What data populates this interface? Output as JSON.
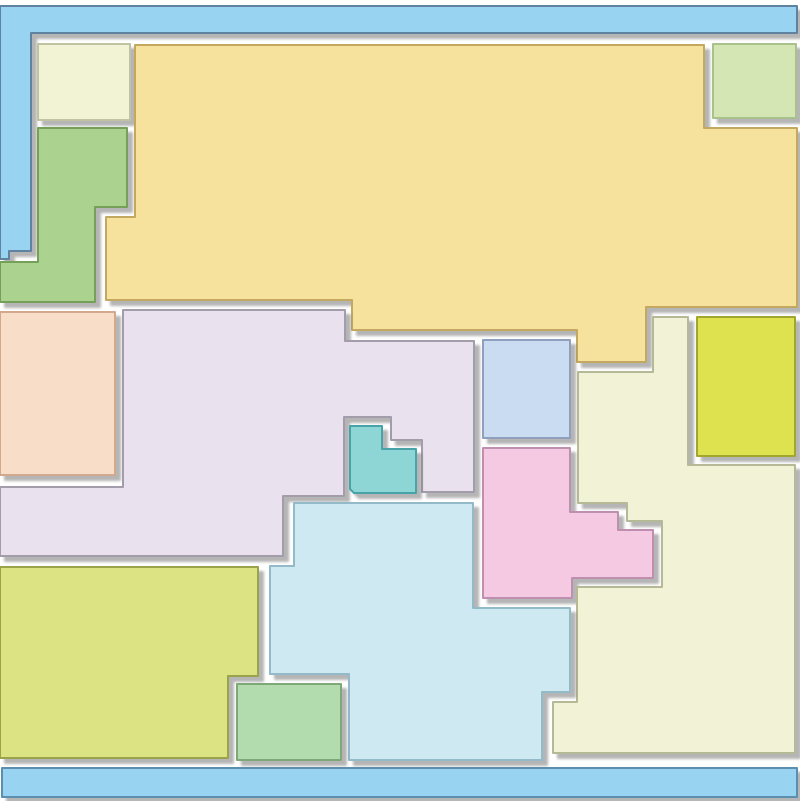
{
  "canvas": {
    "width": 800,
    "height": 801,
    "background": "#ffffff",
    "shadow": {
      "dx": 5,
      "dy": 5,
      "blur": 1.2,
      "color": "#777777",
      "opacity": 0.55
    }
  },
  "palette": {
    "frame_blue": "#98d3f2",
    "frame_blue_stroke": "#5e82a0",
    "bar_blue_stroke": "#5b8fae",
    "yellow": "#f6e29c",
    "ivory": "#f1f2d6",
    "lavender": "#e9e2ee",
    "cyan": "#cfe9f2",
    "lime": "#dce383",
    "chartreuse": "#dfe24f",
    "pink": "#f4c9e1",
    "peach": "#f8ddc9",
    "periwinkle": "#c9dcf2",
    "teal": "#8ed6d6",
    "green": "#abd28e",
    "mint": "#b3dcae",
    "pale_cream": "#f2f2d5",
    "pale_green": "#d4e6b4"
  },
  "shapes": [
    {
      "name": "region-frame-top-left-blue",
      "fill": "#98d3f2",
      "stroke": "#5e82a0",
      "points": [
        [
          0,
          6
        ],
        [
          797,
          6
        ],
        [
          797,
          33
        ],
        [
          31,
          33
        ],
        [
          31,
          251
        ],
        [
          9,
          251
        ],
        [
          9,
          259
        ],
        [
          0,
          259
        ]
      ]
    },
    {
      "name": "region-bottom-bar-blue",
      "fill": "#98d3f2",
      "stroke": "#5b8fae",
      "points": [
        [
          2,
          768
        ],
        [
          797,
          768
        ],
        [
          797,
          797
        ],
        [
          2,
          797
        ]
      ]
    },
    {
      "name": "region-pale-cream-rect-top-left",
      "fill": "#f2f2d5",
      "stroke": "#bfc3a0",
      "points": [
        [
          38,
          44
        ],
        [
          130,
          44
        ],
        [
          130,
          120
        ],
        [
          38,
          120
        ]
      ]
    },
    {
      "name": "region-green-left",
      "fill": "#abd28e",
      "stroke": "#74a058",
      "points": [
        [
          38,
          128
        ],
        [
          127,
          128
        ],
        [
          127,
          207
        ],
        [
          95,
          207
        ],
        [
          95,
          302
        ],
        [
          0,
          302
        ],
        [
          0,
          262
        ],
        [
          38,
          262
        ]
      ]
    },
    {
      "name": "region-yellow-large-top",
      "fill": "#f6e29c",
      "stroke": "#c2a95f",
      "points": [
        [
          135,
          45
        ],
        [
          704,
          45
        ],
        [
          704,
          128
        ],
        [
          797,
          128
        ],
        [
          797,
          307
        ],
        [
          646,
          307
        ],
        [
          646,
          362
        ],
        [
          577,
          362
        ],
        [
          577,
          330
        ],
        [
          352,
          330
        ],
        [
          352,
          300
        ],
        [
          106,
          300
        ],
        [
          106,
          217
        ],
        [
          135,
          217
        ]
      ]
    },
    {
      "name": "region-pale-green-square-top-right",
      "fill": "#d4e6b4",
      "stroke": "#a9c18c",
      "points": [
        [
          713,
          44
        ],
        [
          796,
          44
        ],
        [
          796,
          118
        ],
        [
          713,
          118
        ]
      ]
    },
    {
      "name": "region-peach-rect-left",
      "fill": "#f8ddc9",
      "stroke": "#d2a98c",
      "points": [
        [
          0,
          312
        ],
        [
          115,
          312
        ],
        [
          115,
          475
        ],
        [
          0,
          475
        ]
      ]
    },
    {
      "name": "region-lavender-large-middle",
      "fill": "#e9e2ee",
      "stroke": "#a29cab",
      "points": [
        [
          123,
          310
        ],
        [
          345,
          310
        ],
        [
          345,
          341
        ],
        [
          474,
          341
        ],
        [
          474,
          492
        ],
        [
          422,
          492
        ],
        [
          422,
          440
        ],
        [
          391,
          440
        ],
        [
          391,
          417
        ],
        [
          344,
          417
        ],
        [
          344,
          496
        ],
        [
          283,
          496
        ],
        [
          283,
          556
        ],
        [
          0,
          556
        ],
        [
          0,
          487
        ],
        [
          123,
          487
        ]
      ]
    },
    {
      "name": "region-periwinkle-rect-center",
      "fill": "#c9dcf2",
      "stroke": "#8fa0bf",
      "points": [
        [
          483,
          340
        ],
        [
          570,
          340
        ],
        [
          570,
          438
        ],
        [
          483,
          438
        ]
      ]
    },
    {
      "name": "region-teal-l-piece-center",
      "fill": "#8ed6d6",
      "stroke": "#47a3a8",
      "points": [
        [
          350,
          426
        ],
        [
          382,
          426
        ],
        [
          382,
          449
        ],
        [
          416,
          449
        ],
        [
          416,
          493
        ],
        [
          354,
          493
        ],
        [
          350,
          489
        ]
      ]
    },
    {
      "name": "region-pink-stepped-center",
      "fill": "#f4c9e1",
      "stroke": "#bf8fb0",
      "points": [
        [
          483,
          448
        ],
        [
          570,
          448
        ],
        [
          570,
          512
        ],
        [
          618,
          512
        ],
        [
          618,
          530
        ],
        [
          653,
          530
        ],
        [
          653,
          578
        ],
        [
          572,
          578
        ],
        [
          572,
          598
        ],
        [
          483,
          598
        ]
      ]
    },
    {
      "name": "region-chartreuse-rect-right",
      "fill": "#dfe24f",
      "stroke": "#a0a62f",
      "points": [
        [
          697,
          317
        ],
        [
          795,
          317
        ],
        [
          795,
          456
        ],
        [
          697,
          456
        ]
      ]
    },
    {
      "name": "region-ivory-large-right",
      "fill": "#f1f2d6",
      "stroke": "#b5b995",
      "points": [
        [
          653,
          317
        ],
        [
          688,
          317
        ],
        [
          688,
          465
        ],
        [
          795,
          465
        ],
        [
          795,
          753
        ],
        [
          553,
          753
        ],
        [
          553,
          702
        ],
        [
          577,
          702
        ],
        [
          577,
          587
        ],
        [
          662,
          587
        ],
        [
          662,
          521
        ],
        [
          627,
          521
        ],
        [
          627,
          503
        ],
        [
          578,
          503
        ],
        [
          578,
          372
        ],
        [
          653,
          372
        ]
      ]
    },
    {
      "name": "region-cyan-large-bottom",
      "fill": "#cfe9f2",
      "stroke": "#92bac9",
      "points": [
        [
          294,
          503
        ],
        [
          473,
          503
        ],
        [
          473,
          608
        ],
        [
          570,
          608
        ],
        [
          570,
          692
        ],
        [
          542,
          692
        ],
        [
          542,
          760
        ],
        [
          349,
          760
        ],
        [
          349,
          674
        ],
        [
          270,
          674
        ],
        [
          270,
          566
        ],
        [
          294,
          566
        ]
      ]
    },
    {
      "name": "region-lime-bottom-left",
      "fill": "#dce383",
      "stroke": "#9aa34a",
      "points": [
        [
          0,
          567
        ],
        [
          258,
          567
        ],
        [
          258,
          676
        ],
        [
          228,
          676
        ],
        [
          228,
          758
        ],
        [
          0,
          758
        ]
      ]
    },
    {
      "name": "region-mint-rect-bottom",
      "fill": "#b3dcae",
      "stroke": "#7fa878",
      "points": [
        [
          237,
          684
        ],
        [
          341,
          684
        ],
        [
          341,
          760
        ],
        [
          237,
          760
        ]
      ]
    }
  ]
}
